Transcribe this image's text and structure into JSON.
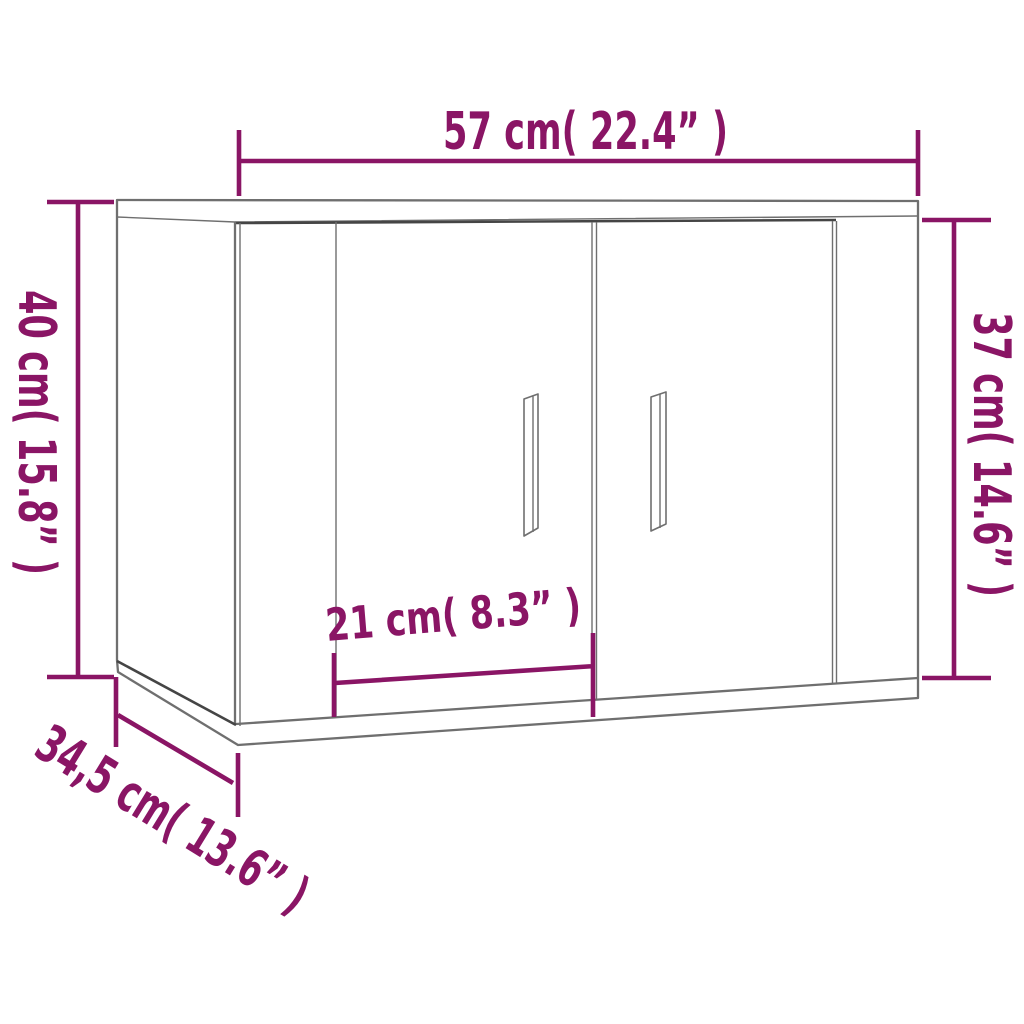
{
  "diagram": {
    "title": "Dimension diagram of a wall-mounted cabinet with two doors",
    "style": {
      "dimension_color": "#8A1565",
      "outline_color": "#6F6F6F",
      "outline_dark_color": "#454545",
      "background_color": "#FFFFFF"
    },
    "labels": {
      "width": "57 cm( 22.4” )",
      "height_left": "40 cm( 15.8” )",
      "height_right": "37 cm( 14.6” )",
      "door_width": "21 cm( 8.3” )",
      "depth": "34,5 cm( 13.6” )"
    },
    "measurements": {
      "width_cm": 57,
      "width_in": 22.4,
      "height_left_cm": 40,
      "height_left_in": 15.8,
      "height_right_cm": 37,
      "height_right_in": 14.6,
      "door_width_cm": 21,
      "door_width_in": 8.3,
      "depth_cm": 34.5,
      "depth_in": 13.6
    }
  }
}
